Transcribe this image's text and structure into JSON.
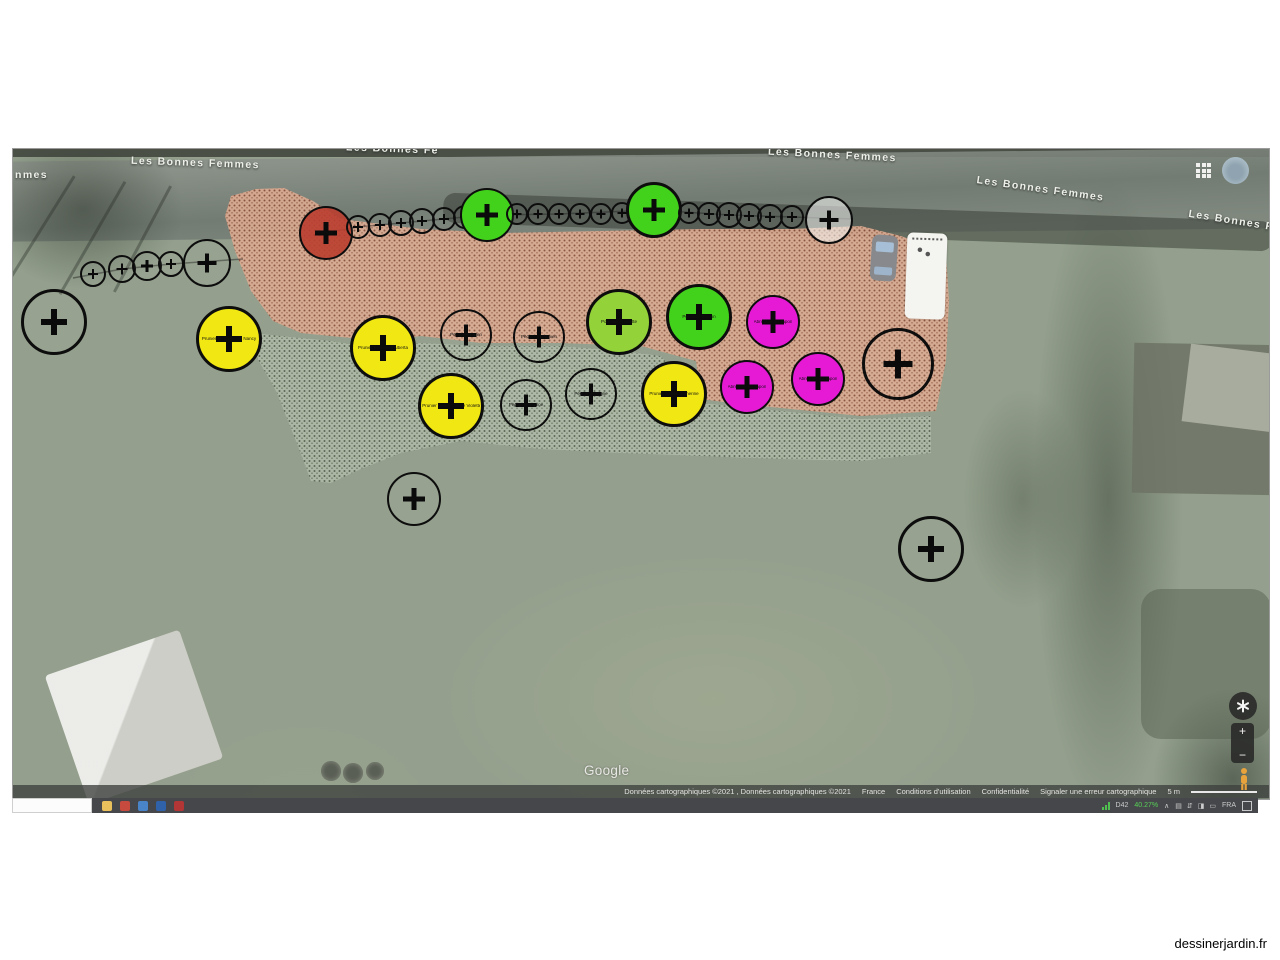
{
  "map": {
    "street_labels": [
      {
        "text": "nmes",
        "x": 2,
        "y": 20,
        "rot": 0
      },
      {
        "text": "Les Bonnes Femmes",
        "x": 118,
        "y": 8,
        "rot": 2
      },
      {
        "text": "Les Bonnes Fe",
        "x": 333,
        "y": -6,
        "rot": 2
      },
      {
        "text": "Les Bonnes Femmes",
        "x": 755,
        "y": 0,
        "rot": 3
      },
      {
        "text": "Les Bonnes Femmes",
        "x": 963,
        "y": 34,
        "rot": 8
      },
      {
        "text": "Les Bonnes Fe",
        "x": 1175,
        "y": 66,
        "rot": 9
      }
    ],
    "plant_colors": {
      "yellow": "#f0e713",
      "green": "#43d21c",
      "apple": "#93d238",
      "magenta": "#e619d5",
      "red": "rgba(186,62,48,0.9)",
      "none": "rgba(255,255,255,0.03)",
      "ghost": "rgba(250,250,248,0.55)"
    },
    "plants": [
      {
        "x": 80,
        "y": 125,
        "r": 13,
        "c": "none",
        "label": ""
      },
      {
        "x": 109,
        "y": 120,
        "r": 14,
        "c": "none",
        "label": ""
      },
      {
        "x": 134,
        "y": 117,
        "r": 15,
        "c": "none",
        "label": ""
      },
      {
        "x": 158,
        "y": 115,
        "r": 13,
        "c": "none",
        "label": ""
      },
      {
        "x": 194,
        "y": 114,
        "r": 24,
        "c": "none",
        "label": ""
      },
      {
        "x": 41,
        "y": 173,
        "r": 33,
        "c": "none",
        "label": ""
      },
      {
        "x": 313,
        "y": 84,
        "r": 27,
        "c": "red",
        "label": "Cerisier"
      },
      {
        "x": 345,
        "y": 78,
        "r": 12,
        "c": "none",
        "label": ""
      },
      {
        "x": 367,
        "y": 76,
        "r": 12,
        "c": "none",
        "label": ""
      },
      {
        "x": 388,
        "y": 74,
        "r": 13,
        "c": "none",
        "label": ""
      },
      {
        "x": 409,
        "y": 72,
        "r": 13,
        "c": "none",
        "label": ""
      },
      {
        "x": 431,
        "y": 70,
        "r": 12,
        "c": "none",
        "label": ""
      },
      {
        "x": 452,
        "y": 68,
        "r": 12,
        "c": "none",
        "label": ""
      },
      {
        "x": 474,
        "y": 66,
        "r": 27,
        "c": "green",
        "label": "Pommier"
      },
      {
        "x": 504,
        "y": 65,
        "r": 11,
        "c": "none",
        "label": ""
      },
      {
        "x": 525,
        "y": 65,
        "r": 11,
        "c": "none",
        "label": ""
      },
      {
        "x": 546,
        "y": 65,
        "r": 11,
        "c": "none",
        "label": ""
      },
      {
        "x": 567,
        "y": 65,
        "r": 11,
        "c": "none",
        "label": ""
      },
      {
        "x": 588,
        "y": 65,
        "r": 11,
        "c": "none",
        "label": ""
      },
      {
        "x": 609,
        "y": 64,
        "r": 11,
        "c": "none",
        "label": ""
      },
      {
        "x": 641,
        "y": 61,
        "r": 28,
        "c": "green",
        "label": "Pommier"
      },
      {
        "x": 676,
        "y": 64,
        "r": 11,
        "c": "none",
        "label": ""
      },
      {
        "x": 696,
        "y": 65,
        "r": 12,
        "c": "none",
        "label": ""
      },
      {
        "x": 716,
        "y": 66,
        "r": 13,
        "c": "none",
        "label": ""
      },
      {
        "x": 736,
        "y": 67,
        "r": 13,
        "c": "none",
        "label": ""
      },
      {
        "x": 757,
        "y": 68,
        "r": 13,
        "c": "none",
        "label": ""
      },
      {
        "x": 779,
        "y": 68,
        "r": 12,
        "c": "none",
        "label": ""
      },
      {
        "x": 816,
        "y": 71,
        "r": 24,
        "c": "ghost",
        "label": ""
      },
      {
        "x": 216,
        "y": 190,
        "r": 33,
        "c": "yellow",
        "label": "Prunier Mirabelle de Nancy"
      },
      {
        "x": 370,
        "y": 199,
        "r": 33,
        "c": "yellow",
        "label": "Prunier Président Alberta"
      },
      {
        "x": 453,
        "y": 186,
        "r": 26,
        "c": "none",
        "label": "Pêcher Amsden"
      },
      {
        "x": 526,
        "y": 188,
        "r": 26,
        "c": "none",
        "label": "Pêcher Redhaven"
      },
      {
        "x": 606,
        "y": 173,
        "r": 33,
        "c": "apple",
        "label": "Pommier Reinette"
      },
      {
        "x": 686,
        "y": 168,
        "r": 33,
        "c": "green",
        "label": "Pommier Pigeon"
      },
      {
        "x": 760,
        "y": 173,
        "r": 27,
        "c": "magenta",
        "label": "Abricotier du Japon"
      },
      {
        "x": 885,
        "y": 215,
        "r": 36,
        "c": "none",
        "label": ""
      },
      {
        "x": 438,
        "y": 257,
        "r": 33,
        "c": "yellow",
        "label": "Prunier Reine Claude Violette"
      },
      {
        "x": 513,
        "y": 256,
        "r": 26,
        "c": "none",
        "label": "Pêcher Sanguine"
      },
      {
        "x": 578,
        "y": 245,
        "r": 26,
        "c": "none",
        "label": "Pêcher de Vigne"
      },
      {
        "x": 661,
        "y": 245,
        "r": 33,
        "c": "yellow",
        "label": "Prunier Sainte Catherine"
      },
      {
        "x": 734,
        "y": 238,
        "r": 27,
        "c": "magenta",
        "label": "Abricotier du Japon"
      },
      {
        "x": 805,
        "y": 230,
        "r": 27,
        "c": "magenta",
        "label": "Abricotier du Japon"
      },
      {
        "x": 401,
        "y": 350,
        "r": 27,
        "c": "none",
        "label": "Pommier"
      },
      {
        "x": 918,
        "y": 400,
        "r": 33,
        "c": "none",
        "label": "Poirier"
      }
    ],
    "shrubs": [
      {
        "x": 318,
        "y": 622,
        "r": 10
      },
      {
        "x": 340,
        "y": 624,
        "r": 10
      },
      {
        "x": 362,
        "y": 622,
        "r": 9
      }
    ],
    "google_logo": "Google",
    "attribution": {
      "items": [
        {
          "text": "Données cartographiques ©2021 , Données cartographiques ©2021",
          "link": false
        },
        {
          "text": "France",
          "link": false
        },
        {
          "text": "Conditions d'utilisation",
          "link": true
        },
        {
          "text": "Confidentialité",
          "link": true
        },
        {
          "text": "Signaler une erreur cartographique",
          "link": true
        },
        {
          "text": "5 m",
          "link": false
        }
      ]
    },
    "controls": {
      "zoom_in_label": "+",
      "zoom_out_label": "−"
    }
  },
  "taskbar": {
    "app_icons": [
      {
        "name": "file-explorer",
        "color": "#eac05c"
      },
      {
        "name": "app-red",
        "color": "#c64a3e"
      },
      {
        "name": "app-blue",
        "color": "#4a84c8"
      },
      {
        "name": "app-blue-dark",
        "color": "#2f62a8"
      },
      {
        "name": "app-red-dark",
        "color": "#b23636"
      }
    ],
    "tray": {
      "monitor_label": "D42",
      "percent": "40.27%",
      "chevron": "∧",
      "glyphs": [
        "▤",
        "⇵",
        "◨",
        "▭"
      ],
      "lang": "FRA"
    }
  },
  "branding": "dessinerjardin.fr"
}
